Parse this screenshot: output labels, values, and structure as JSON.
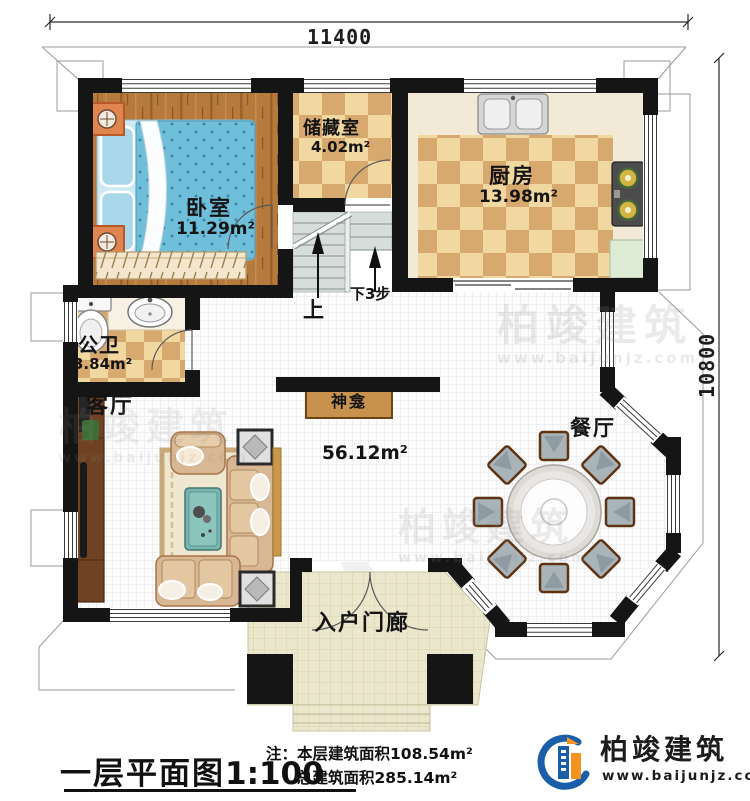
{
  "dimensions": {
    "width_top": "11400",
    "height_right": "10800"
  },
  "rooms": {
    "bedroom": {
      "name": "卧室",
      "area": "11.29m²"
    },
    "storage": {
      "name": "储藏室",
      "area": "4.02m²"
    },
    "kitchen": {
      "name": "厨房",
      "area": "13.98m²"
    },
    "bathroom": {
      "name": "公卫",
      "area": "3.84m²"
    },
    "living": {
      "name": "客厅"
    },
    "dining": {
      "name": "餐厅"
    },
    "living_dining_area": "56.12m²",
    "shrine": {
      "name": "神龛"
    },
    "porch": {
      "name": "入户门廊"
    }
  },
  "stairs": {
    "up_label": "上",
    "down_label": "下3步"
  },
  "title_block": {
    "title": "一层平面图",
    "scale": "1:100",
    "note_prefix": "注：",
    "note_line1": "本层建筑面积108.54m²",
    "note_line2": "总建筑面积285.14m²"
  },
  "logo": {
    "company": "柏竣建筑",
    "website": "www.baijunjz.com"
  },
  "watermark": {
    "company": "柏竣建筑",
    "website": "www.baijunjz.com"
  },
  "colors": {
    "wall": "#151515",
    "wood_floor": "#b5793c",
    "tile_light": "#f1d7a0",
    "tile_dark": "#d8a96e",
    "bed_blue": "#6fbeda",
    "logo_blue": "#1b5ea8",
    "logo_orange": "#f2941f"
  }
}
